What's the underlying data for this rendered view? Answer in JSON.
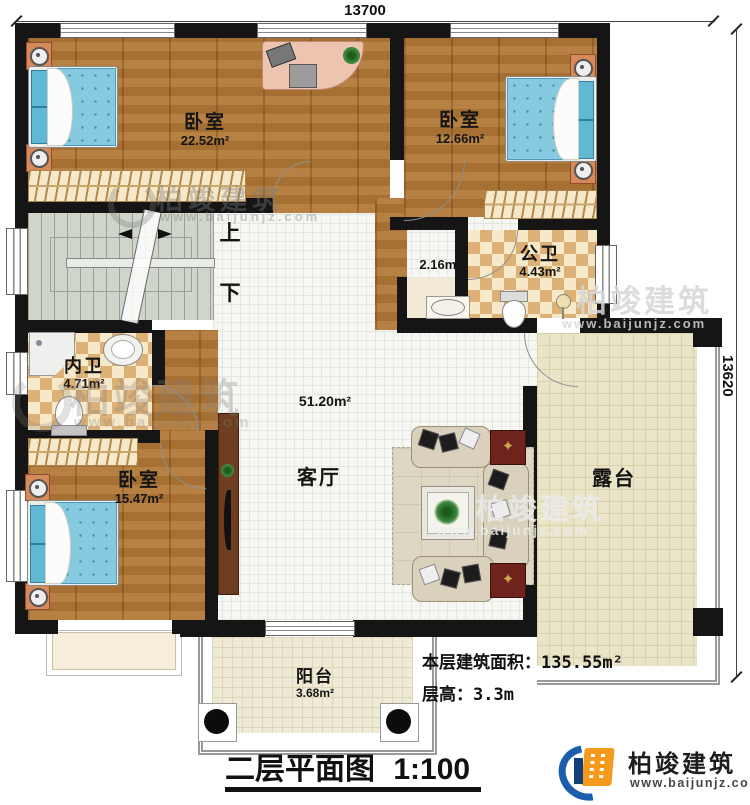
{
  "plan": {
    "dim_top": "13700",
    "dim_right": "13620",
    "rooms": {
      "bedroom1": {
        "label": "卧室",
        "area": "22.52m²"
      },
      "bedroom2": {
        "label": "卧室",
        "area": "12.66m²"
      },
      "bedroom3": {
        "label": "卧室",
        "area": "15.47m²"
      },
      "public_bath": {
        "label": "公卫",
        "area": "4.43m²"
      },
      "wash_area": {
        "area": "2.16m²"
      },
      "private_bath": {
        "label": "内卫",
        "area": "4.71m²"
      },
      "living": {
        "label": "客厅",
        "area": "51.20m²"
      },
      "terrace": {
        "label": "露台"
      },
      "balcony": {
        "label": "阳台",
        "area": "3.68m²"
      }
    },
    "stairs": {
      "up": "上",
      "down": "下"
    }
  },
  "info": {
    "area_label": "本层建筑面积：",
    "area_value": "135.55m²",
    "height_label": "层高：",
    "height_value": "3.3m"
  },
  "title": {
    "name": "二层平面图",
    "scale": "1:100"
  },
  "brand": {
    "name": "柏竣建筑",
    "url": "www.baijunjz.com"
  },
  "watermark": {
    "name": "柏竣建筑",
    "url": "www.baijunjz.com"
  },
  "colors": {
    "wall": "#151515",
    "wood": "#b07735",
    "tile": "#f6f6f3",
    "checker": "#ddb175",
    "terrace": "#eae5c9",
    "bed": "#85cade",
    "brand_blue": "#1a5dab",
    "brand_orange": "#f59a1d"
  }
}
